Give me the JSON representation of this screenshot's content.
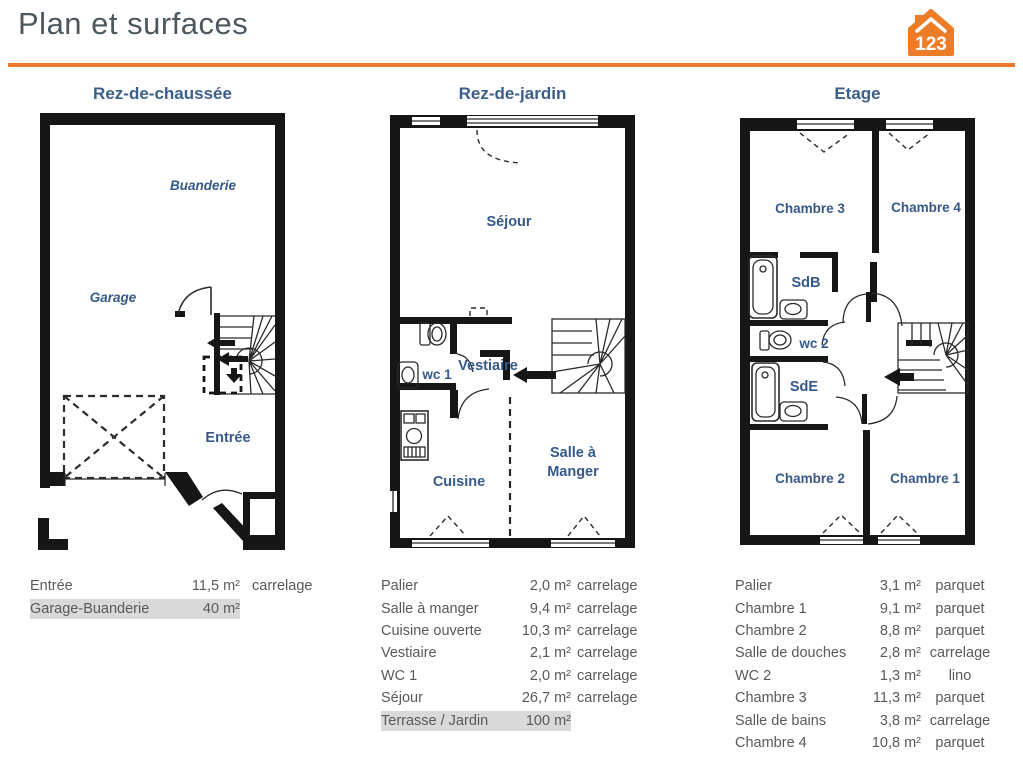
{
  "header": {
    "title": "Plan et surfaces",
    "logo_text": "123",
    "accent_color": "#e87b2f"
  },
  "plans": [
    {
      "title": "Rez-de-chaussée",
      "labels": {
        "buanderie": "Buanderie",
        "garage": "Garage",
        "entree": "Entrée"
      }
    },
    {
      "title": "Rez-de-jardin",
      "labels": {
        "sejour": "Séjour",
        "wc1": "wc 1",
        "vestiaire": "Vestiaire",
        "cuisine": "Cuisine",
        "salle_a": "Salle à",
        "manger": "Manger"
      }
    },
    {
      "title": "Etage",
      "labels": {
        "chambre3": "Chambre 3",
        "chambre4": "Chambre 4",
        "sdb": "SdB",
        "wc2": "wc 2",
        "sde": "SdE",
        "chambre2": "Chambre 2",
        "chambre1": "Chambre 1"
      }
    }
  ],
  "tables": [
    {
      "rows": [
        {
          "name": "Entrée",
          "area": "11,5 m²",
          "floor": "carrelage",
          "highlight": false
        },
        {
          "name": "Garage-Buanderie",
          "area": "40 m²",
          "floor": "",
          "highlight": true
        }
      ]
    },
    {
      "rows": [
        {
          "name": "Palier",
          "area": "2,0 m²",
          "floor": "carrelage",
          "highlight": false
        },
        {
          "name": "Salle à manger",
          "area": "9,4 m²",
          "floor": "carrelage",
          "highlight": false
        },
        {
          "name": "Cuisine ouverte",
          "area": "10,3 m²",
          "floor": "carrelage",
          "highlight": false
        },
        {
          "name": "Vestiaire",
          "area": "2,1 m²",
          "floor": "carrelage",
          "highlight": false
        },
        {
          "name": "WC 1",
          "area": "2,0 m²",
          "floor": "carrelage",
          "highlight": false
        },
        {
          "name": "Séjour",
          "area": "26,7 m²",
          "floor": "carrelage",
          "highlight": false
        },
        {
          "name": "Terrasse / Jardin",
          "area": "100 m²",
          "floor": "",
          "highlight": true
        }
      ]
    },
    {
      "rows": [
        {
          "name": "Palier",
          "area": "3,1 m²",
          "floor": "parquet",
          "highlight": false
        },
        {
          "name": "Chambre 1",
          "area": "9,1 m²",
          "floor": "parquet",
          "highlight": false
        },
        {
          "name": "Chambre 2",
          "area": "8,8 m²",
          "floor": "parquet",
          "highlight": false
        },
        {
          "name": "Salle de douches",
          "area": "2,8 m²",
          "floor": "carrelage",
          "highlight": false
        },
        {
          "name": "WC 2",
          "area": "1,3 m²",
          "floor": "lino",
          "highlight": false
        },
        {
          "name": "Chambre 3",
          "area": "11,3 m²",
          "floor": "parquet",
          "highlight": false
        },
        {
          "name": "Salle de bains",
          "area": "3,8 m²",
          "floor": "carrelage",
          "highlight": false
        },
        {
          "name": "Chambre 4",
          "area": "10,8 m²",
          "floor": "parquet",
          "highlight": false
        }
      ]
    }
  ]
}
